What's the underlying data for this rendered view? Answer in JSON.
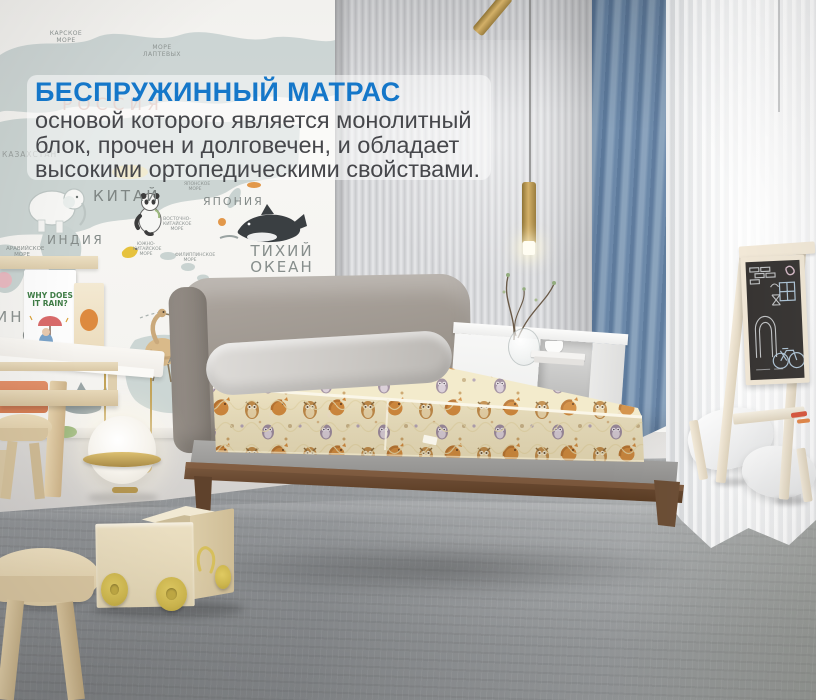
{
  "overlay": {
    "title": "БЕСПРУЖИННЫЙ МАТРАС",
    "lines": [
      "основой которого является монолитный",
      "блок, прочен и долговечен, и обладает",
      "высокими ортопедическими свойствами."
    ],
    "title_color": "#1577c9",
    "text_color": "#46474b"
  },
  "map": {
    "labels": [
      "КАРСКОЕ МОРЕ",
      "МОРЕ ЛАПТЕВЫХ",
      "РОССИЯ",
      "КАЗАХСТАН",
      "КИТАЙ",
      "ЯПОНСКОЕ МОРЕ",
      "ЯПОНИЯ",
      "ИНДИЯ",
      "ВОСТОЧНО-КИТАЙСКОЕ МОРЕ",
      "ЮЖНО-КИТАЙСКОЕ МОРЕ",
      "ФИЛИППИНСКОЕ МОРЕ",
      "АРАВИЙСКОЕ МОРЕ",
      "ТИХИЙ ОКЕАН",
      "ИНД",
      "ОКЕАН",
      "АВС"
    ]
  },
  "shelf": {
    "book_title": "WHY DOES IT RAIN?"
  },
  "colors": {
    "accent_blue": "#1577c9",
    "body_text": "#46474b",
    "curtain_blue": "#7a94b2",
    "mattress_cream": "#f1e7c4",
    "pattern_orange": "#d08c3e",
    "pattern_purple": "#9c8ba0",
    "bed_wood_brown": "#6b4b33",
    "headboard_gray": "#9a938b",
    "carpet_gray": "#8f9295",
    "brass_gold": "#c2a257",
    "toy_yellow": "#d8c25c"
  }
}
